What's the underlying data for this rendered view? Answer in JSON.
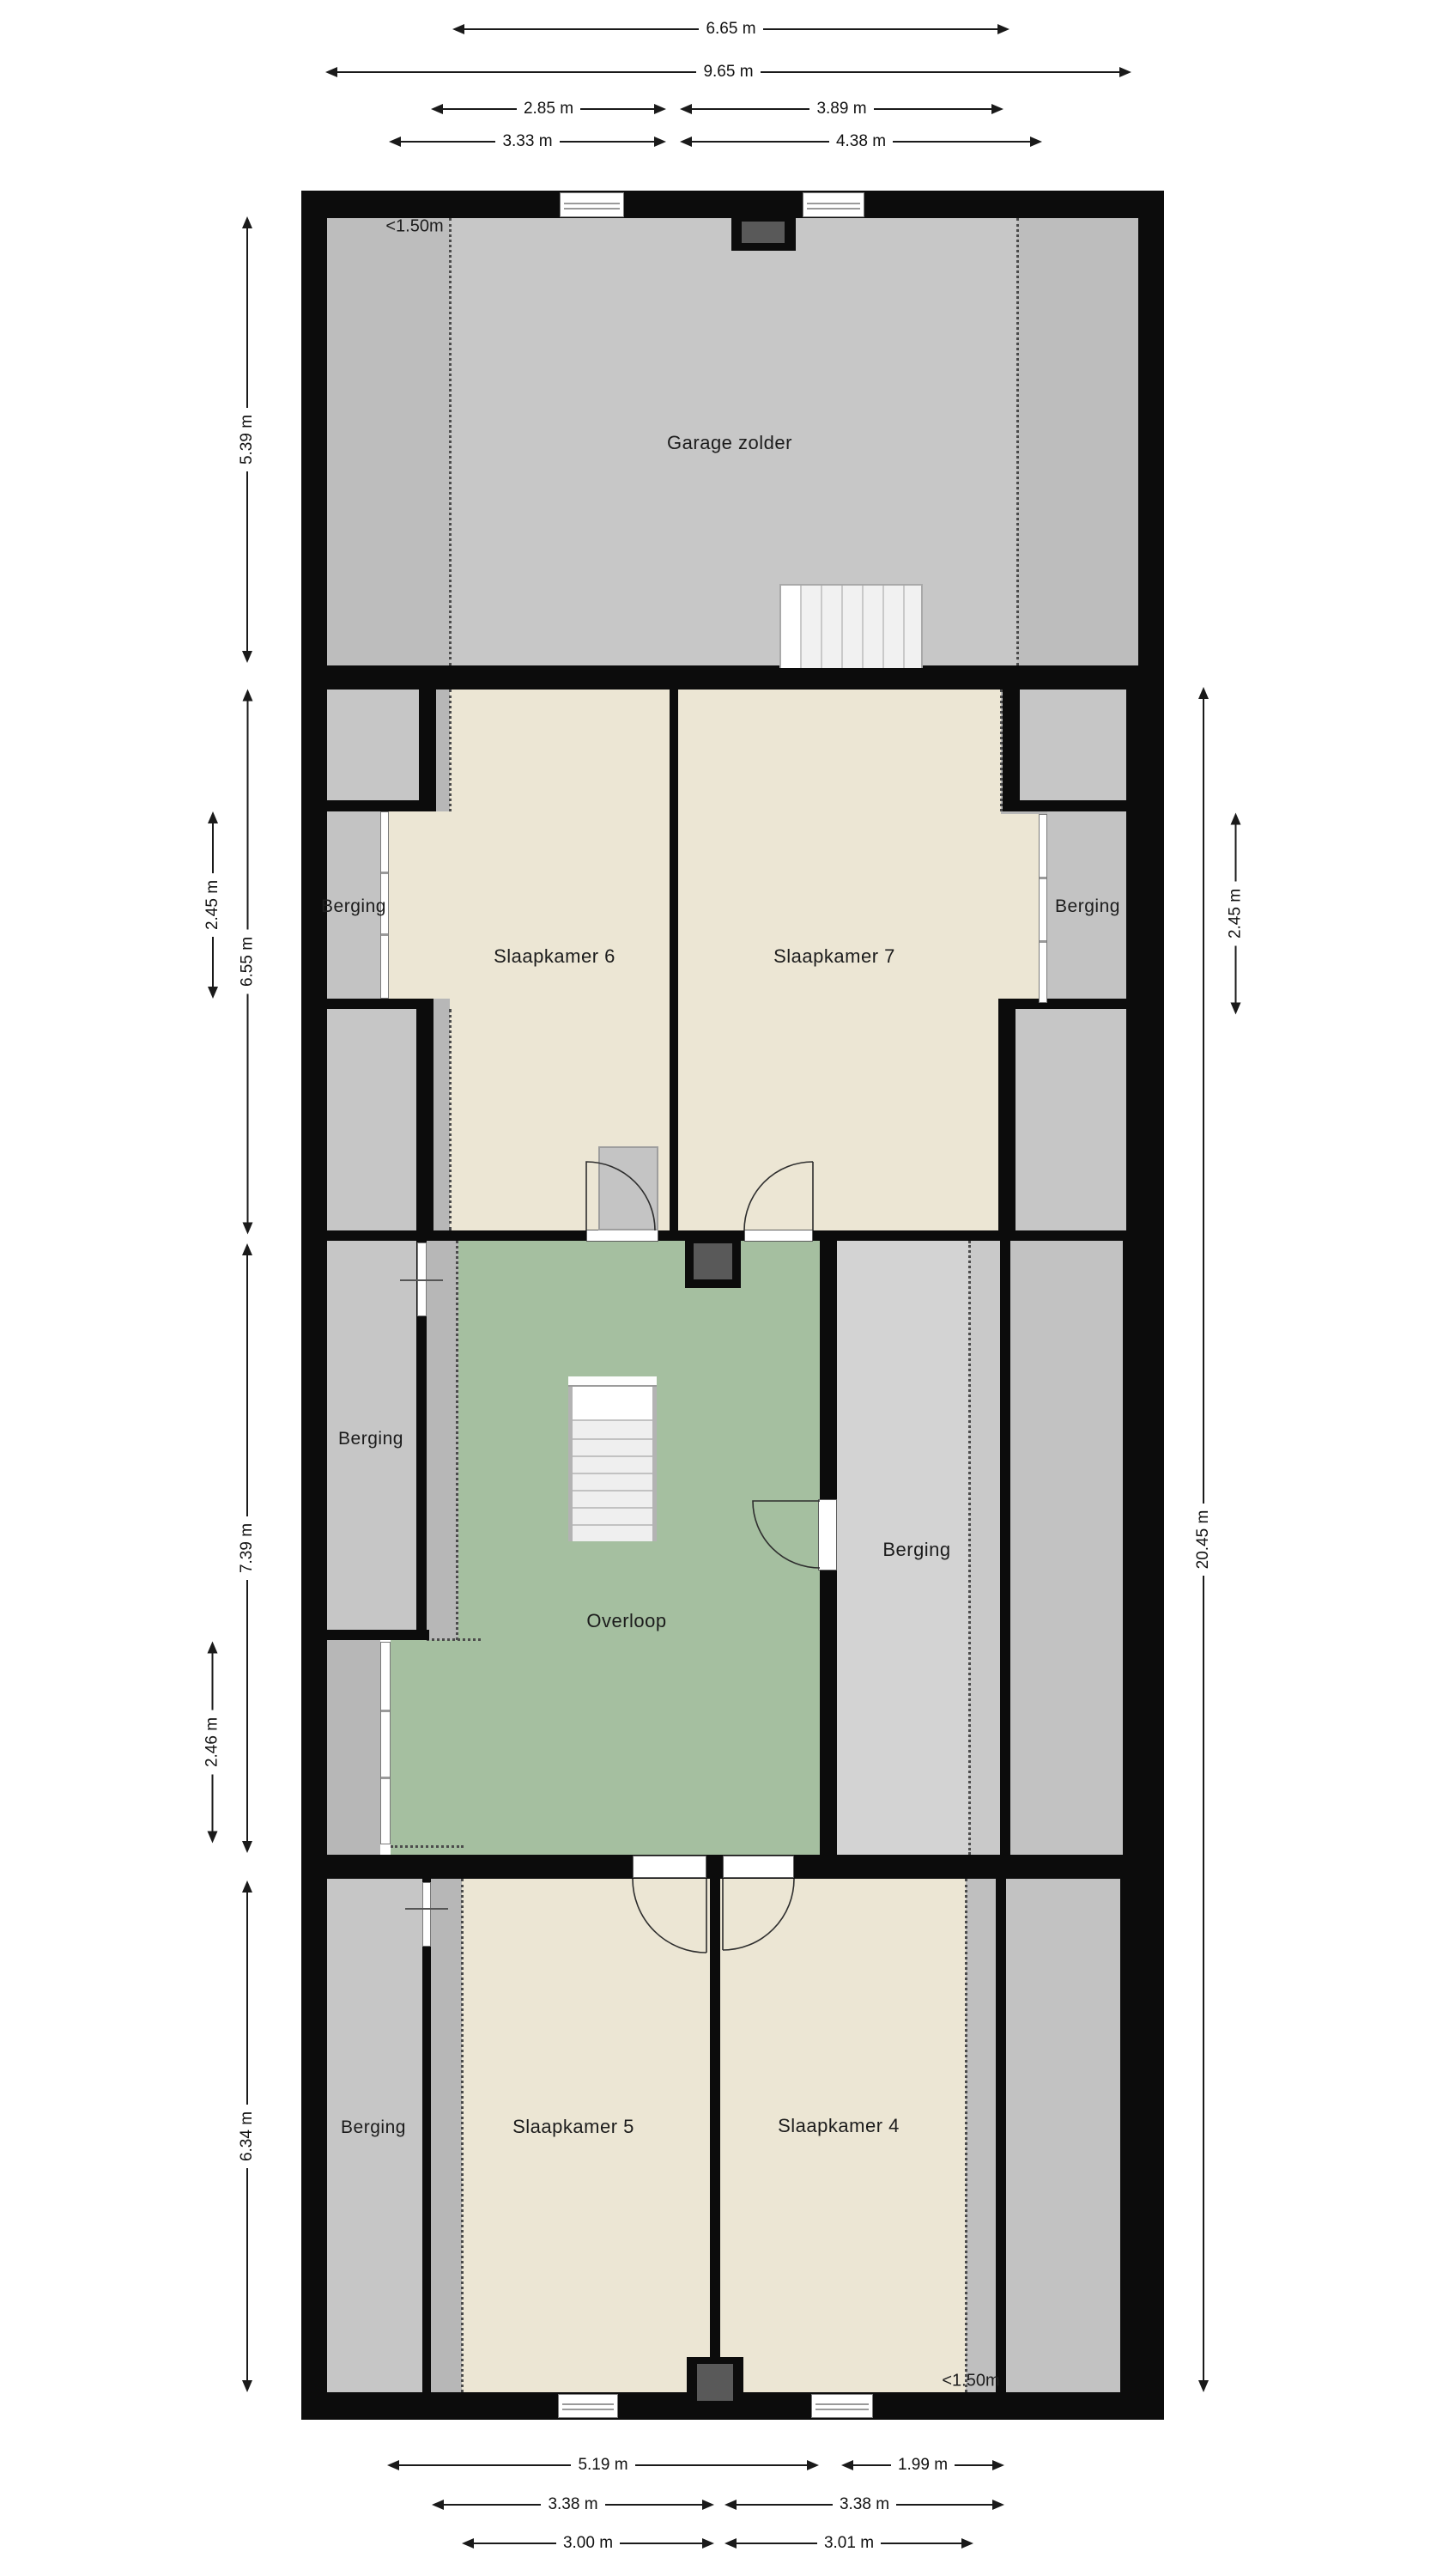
{
  "page": {
    "type": "floor-plan",
    "background": "#ffffff",
    "units": "m"
  },
  "rooms": {
    "garage": "Garage zolder",
    "slaapkamer6": "Slaapkamer 6",
    "slaapkamer7": "Slaapkamer 7",
    "slaapkamer5": "Slaapkamer 5",
    "slaapkamer4": "Slaapkamer 4",
    "overloop": "Overloop",
    "berging": "Berging"
  },
  "annotations": {
    "low_headroom_top": "<1.50m",
    "low_headroom_bottom": "<1.50m"
  },
  "dimensions": {
    "top": [
      "6.65 m",
      "9.65 m",
      "2.85 m",
      "3.89 m",
      "3.33 m",
      "4.38 m"
    ],
    "bottom": [
      "5.19 m",
      "1.99 m",
      "3.38 m",
      "3.38 m",
      "3.00 m",
      "3.01 m"
    ],
    "left": [
      "5.39 m",
      "6.55 m",
      "2.45 m",
      "7.39 m",
      "2.46 m",
      "6.34 m"
    ],
    "right": [
      "2.45 m",
      "20.45 m"
    ]
  },
  "colors": {
    "wall": "#0c0c0c",
    "floor_cream": "#ece6d4",
    "floor_green": "#a5bfa0",
    "floor_gray_garage": "#c7c7c7",
    "floor_gray_slope": "#b7b7b7",
    "floor_gray_storage": "#c6c6c6",
    "floor_gray_storage_light": "#d3d3d3",
    "chimney_inner": "#595959",
    "dimension_line": "#1a1a1a"
  }
}
